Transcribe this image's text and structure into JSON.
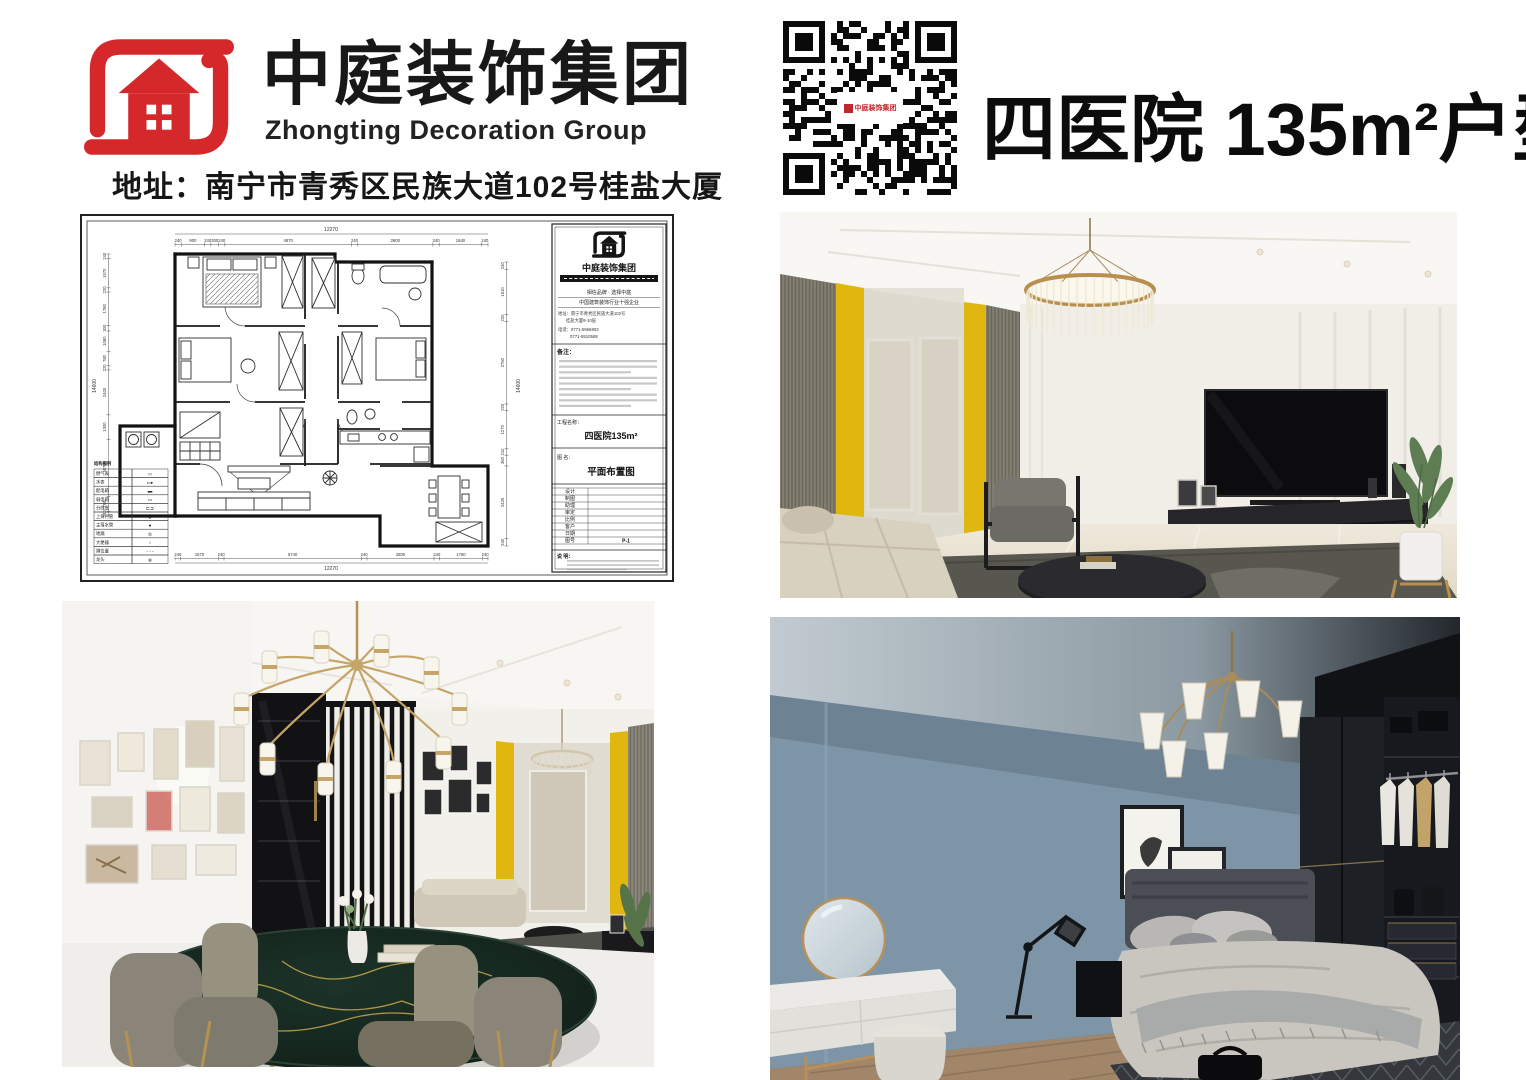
{
  "header": {
    "brand_cn": "中庭装饰集团",
    "brand_en": "Zhongting Decoration Group",
    "address": "地址：南宁市青秀区民族大道102号桂盐大厦",
    "title": "四医院 135m²户型",
    "logo_color": "#d5282b",
    "text_color": "#111111"
  },
  "qr": {
    "center_label": "中庭装饰集团"
  },
  "plan": {
    "dims": {
      "top_total": "12270",
      "top": [
        "240",
        "900",
        "240",
        "300",
        "240",
        "4870",
        "240",
        "2900",
        "240",
        "1640",
        "240"
      ],
      "bottom": [
        "240",
        "1570",
        "240",
        "5740",
        "240",
        "2800",
        "240",
        "1780",
        "240"
      ],
      "bottom_total": "12270",
      "left_total": "14600",
      "left": [
        "240",
        "1570",
        "220",
        "1780",
        "300",
        "1080",
        "780",
        "220",
        "2400",
        "1300",
        "3070",
        "790",
        "240"
      ],
      "right": [
        "240",
        "1510",
        "220",
        "2750",
        "220",
        "1270",
        "210",
        "360",
        "2420",
        "240"
      ],
      "right_total": "14600"
    },
    "legend": {
      "title": "结构图例",
      "rows": [
        {
          "label": "燃气表",
          "sym": "▭"
        },
        {
          "label": "水表",
          "sym": "▭▸"
        },
        {
          "label": "配电箱",
          "sym": "▬"
        },
        {
          "label": "弱电箱",
          "sym": "▭"
        },
        {
          "label": "分线盒",
          "sym": "⊏⊐"
        },
        {
          "label": "上排污管",
          "sym": "⊗"
        },
        {
          "label": "主落水管",
          "sym": "●"
        },
        {
          "label": "地漏",
          "sym": "◎"
        },
        {
          "label": "大便器",
          "sym": "○"
        },
        {
          "label": "蹲位置",
          "sym": "- - -"
        },
        {
          "label": "龙头",
          "sym": "⊕"
        }
      ]
    },
    "titleblock": {
      "company": "中庭装饰集团",
      "slogan1": "相信品牌 · 选择中庭",
      "slogan2": "中国建筑装饰行业十强企业",
      "addr1": "地址：南宁市青秀区民族大道102号",
      "addr2": "桂盐大厦9-10层",
      "tel1": "电话：0771-5966803",
      "tel2": "0771-5510588",
      "note_label": "备注：",
      "project_label": "工程名称：",
      "project_value": "四医院135m²",
      "drawing_label": "图  名：",
      "drawing_value": "平面布置图",
      "fields": [
        "设计",
        "制图",
        "助理",
        "审定",
        "比例",
        "客户",
        "日期"
      ],
      "no_label": "图号",
      "no_value": "P-1",
      "remark_label": "说  明："
    }
  },
  "scenes": {
    "living": {
      "accent_yellow": "#dfb70f",
      "wall": "#f2efe9",
      "rug": "#57574f",
      "cabinet": "#26262a",
      "tv": "#0c0c0e",
      "sofa": "#d9d1bf",
      "floor": "#e9e3d4",
      "gold": "#b98f4e"
    },
    "dining": {
      "marble": "#152620",
      "vein_gold": "#c9a94f",
      "chair": "#94907f",
      "chandelier_gold": "#c5a568",
      "cabinet_black": "#121215",
      "accent_yellow": "#dfb70f",
      "floor": "#f0eeea"
    },
    "bedroom": {
      "wall_blue": "#7d95a7",
      "wardrobe": "#1d2025",
      "duvet": "#c9c6c0",
      "headboard": "#4b4e54",
      "floor_wood": "#a1866a",
      "rug": "#34383d",
      "brass": "#a98c5a"
    }
  }
}
